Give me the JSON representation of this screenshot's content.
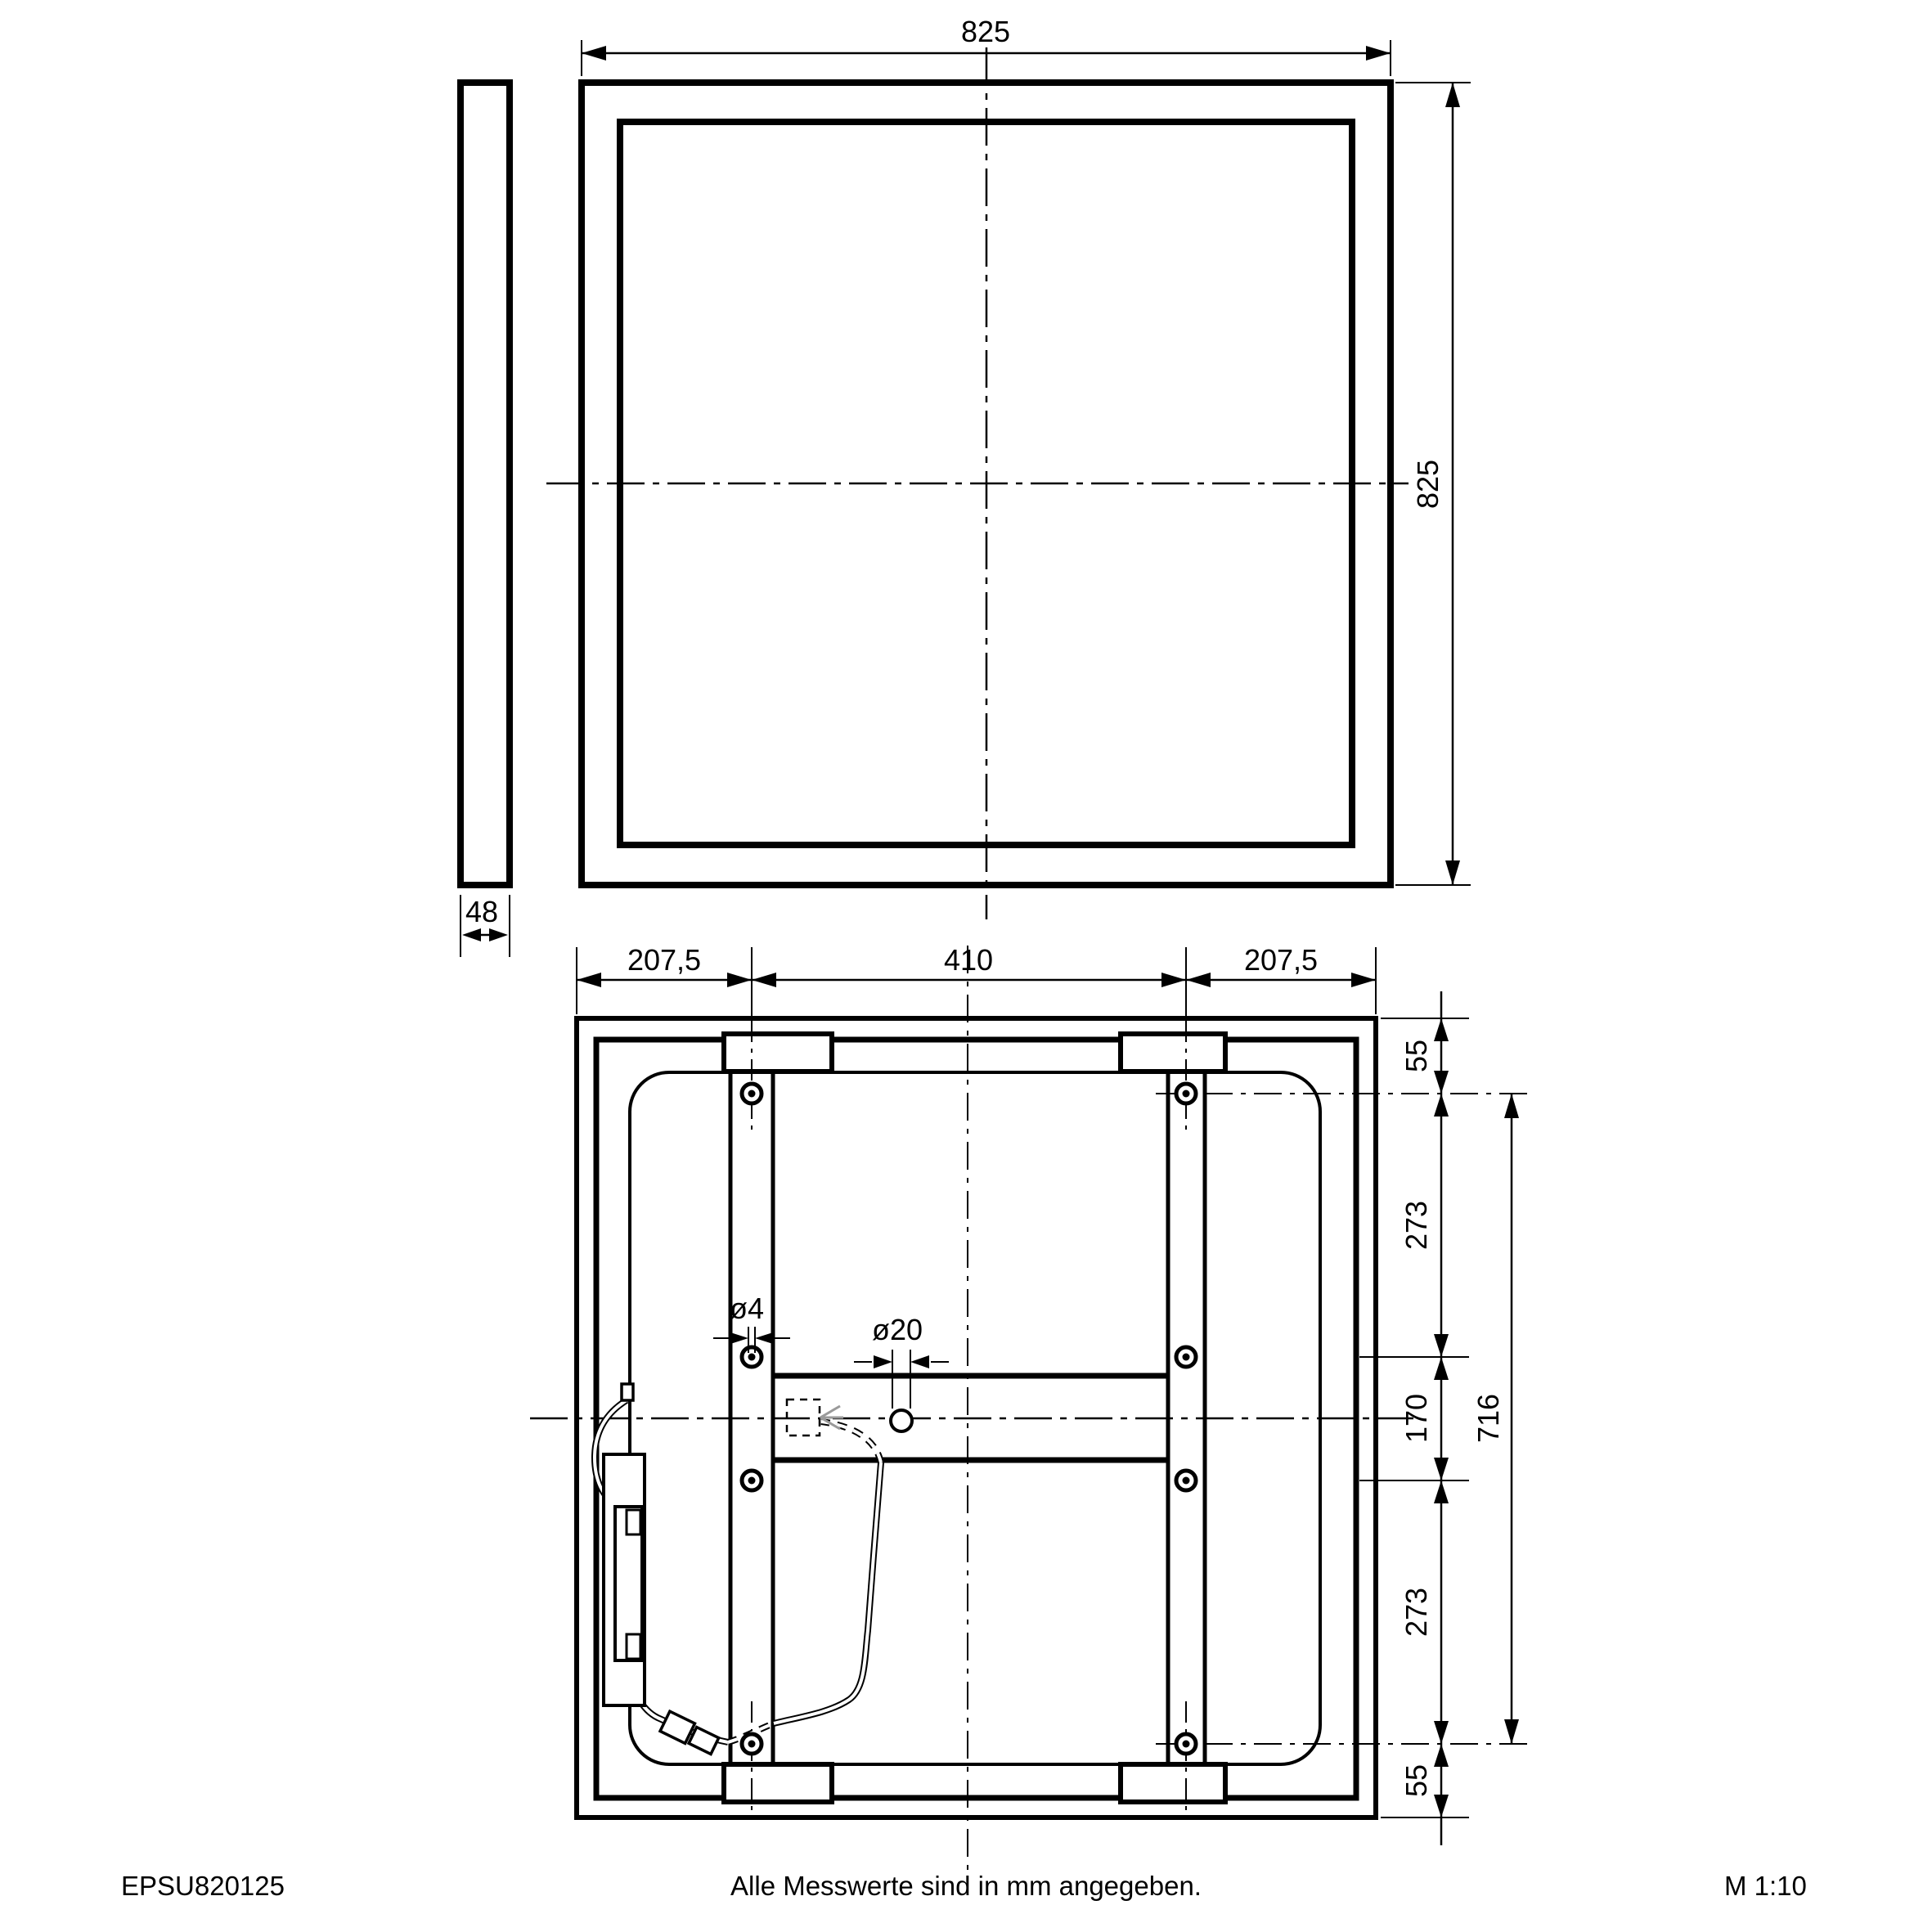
{
  "page": {
    "product_code": "EPSU820125",
    "footer_note": "Alle Messwerte sind in mm angegeben.",
    "scale_label": "M 1:10"
  },
  "side_view": {
    "depth": "48"
  },
  "front_view": {
    "width": "825",
    "height": "825"
  },
  "back_view": {
    "top_segments": {
      "left": "207,5",
      "center": "410",
      "right": "207,5"
    },
    "right_segments": {
      "s1": "55",
      "s2": "273",
      "s3": "170",
      "s4": "273",
      "s5": "55"
    },
    "overall_height": "716",
    "screw_hole_diameter": "ø4",
    "cable_hole_diameter": "ø20"
  },
  "colors": {
    "line": "#000000",
    "background": "#ffffff",
    "plug_arrow": "#9a9a9a"
  }
}
